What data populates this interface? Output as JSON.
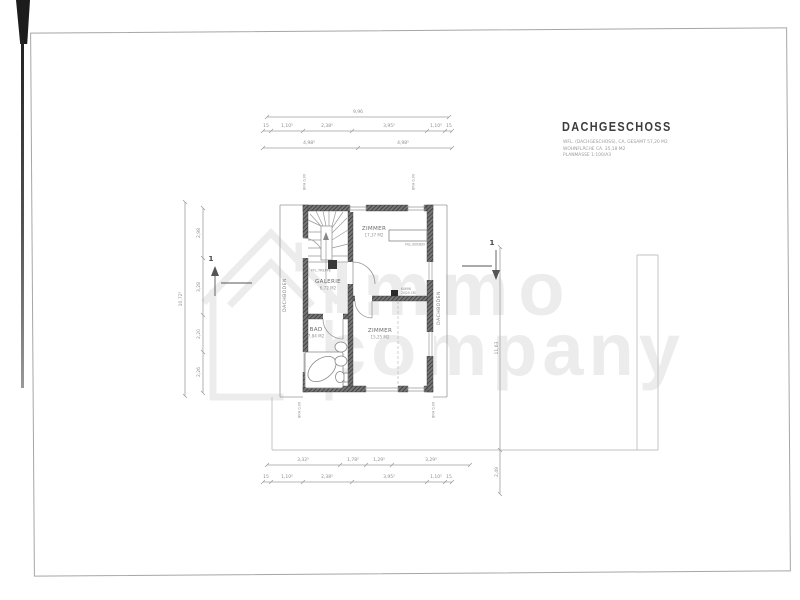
{
  "document": {
    "title": "DACHGESCHOSS",
    "subtitle_lines": [
      "WFL. (DACHGESCHOSS), CA. GESAMT 57,20 M2",
      "WOHNFLÄCHE CA. 35,18 M2",
      "PLANMASSE 1:100/A3"
    ]
  },
  "watermark": {
    "line1": "Immo",
    "line2": "company"
  },
  "rooms": {
    "zimmer_top": {
      "name": "ZIMMER",
      "area": "17,37 M2"
    },
    "zimmer_bottom": {
      "name": "ZIMMER",
      "area": "15,25 M2"
    },
    "galerie": {
      "name": "GALERIE",
      "area": "6,72 M2"
    },
    "bad": {
      "name": "BAD",
      "area": "7,84 M2"
    },
    "dachboden_left": {
      "name": "DACHBODEN"
    },
    "dachboden_right": {
      "name": "DACHBODEN"
    }
  },
  "annotations": {
    "stair_label": "FFL.TREPPE",
    "radiator_label": "FEL.BODEN",
    "chimney_line1": "KAMIN",
    "chimney_line2": "20/20 CM",
    "window_height": "BRH 0,90",
    "section_number": "1"
  },
  "dimensions": {
    "top_overall": "9,96",
    "top_edge_marks": [
      "15",
      "15"
    ],
    "top_segments": [
      "1,10⁵",
      "2,38⁵",
      "3,95⁵",
      "1,10⁵"
    ],
    "top_halves": [
      "4,98⁵",
      "4,98⁵"
    ],
    "bottom_row1": [
      "3,32⁵",
      "1,78⁵",
      "1,29⁵",
      "3,29⁵"
    ],
    "bottom_edge_marks": [
      "15",
      "15"
    ],
    "bottom_segments": [
      "1,10⁵",
      "2,38⁵",
      "3,95⁵",
      "1,10⁵"
    ],
    "left_overall": "10,72⁵",
    "left_segments": [
      "2,98",
      "3,28",
      "2,20",
      "2,26"
    ],
    "right_segments": [
      "11,63",
      "2,49"
    ]
  },
  "colors": {
    "wall": "#4f4f4f",
    "line": "#9a9a9a",
    "dim_text": "#8f8f8f",
    "title_text": "#3c3c3c",
    "watermark": "#ececec"
  }
}
